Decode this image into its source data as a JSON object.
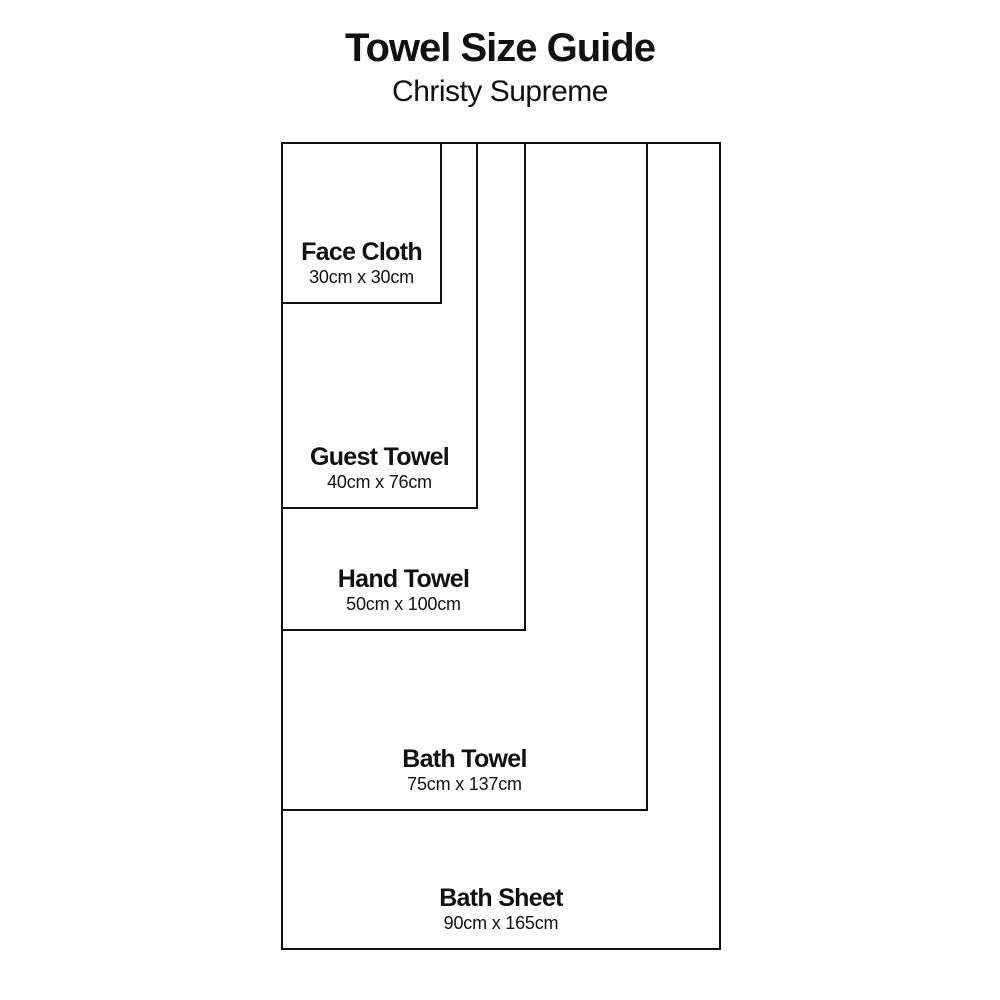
{
  "title": "Towel Size Guide",
  "subtitle": "Christy Supreme",
  "colors": {
    "line": "#111111",
    "text": "#111111",
    "background": "#ffffff"
  },
  "towels": [
    {
      "name": "Face Cloth",
      "dims": "30cm x 30cm",
      "width_cm": 30,
      "length_cm": 30
    },
    {
      "name": "Guest Towel",
      "dims": "40cm x 76cm",
      "width_cm": 40,
      "length_cm": 76
    },
    {
      "name": "Hand Towel",
      "dims": "50cm x 100cm",
      "width_cm": 50,
      "length_cm": 100
    },
    {
      "name": "Bath Towel",
      "dims": "75cm x 137cm",
      "width_cm": 75,
      "length_cm": 137
    },
    {
      "name": "Bath Sheet",
      "dims": "90cm x 165cm",
      "width_cm": 90,
      "length_cm": 165
    }
  ]
}
